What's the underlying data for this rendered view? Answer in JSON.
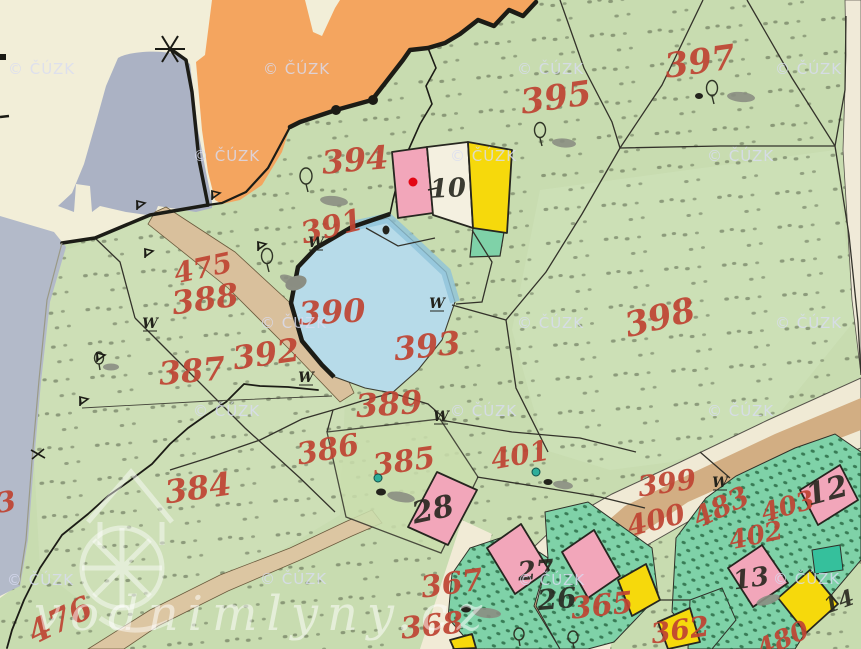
{
  "palette": {
    "paper": "#f2eed8",
    "green": "#c8dcb0",
    "green_light": "#d3e4c0",
    "orange": "#f4a55f",
    "gray_blue": "#abb2c4",
    "pond": "#b7dbe9",
    "pond_rim": "#8fc3da",
    "road_tan": "#d9c09c",
    "road_brown": "#cfa87c",
    "road_cream": "#f0ead5",
    "teal_garden": "#7fd2a8",
    "teal_bright": "#35c09c",
    "building_pink": "#f2a6ba",
    "building_yellow": "#f6d90c",
    "label_red": "#bf4433",
    "label_black": "#26261f",
    "boundary_ink": "#33322a",
    "watermark": "#d9dcf2",
    "red_dot": "#e30613",
    "well_teal": "#2fae9b"
  },
  "watermarks": {
    "cuzk": "© ČÚZK",
    "site": "vodnimlyny.cz",
    "cuzk_positions": [
      [
        8,
        74
      ],
      [
        263,
        74
      ],
      [
        517,
        74
      ],
      [
        775,
        74
      ],
      [
        193,
        161
      ],
      [
        450,
        161
      ],
      [
        707,
        161
      ],
      [
        260,
        328
      ],
      [
        517,
        328
      ],
      [
        775,
        328
      ],
      [
        193,
        416
      ],
      [
        450,
        416
      ],
      [
        707,
        416
      ],
      [
        7,
        585
      ],
      [
        260,
        584
      ],
      [
        518,
        585
      ],
      [
        773,
        584
      ]
    ]
  },
  "parcel_labels": [
    {
      "text": "397",
      "x": 700,
      "y": 62,
      "rot": -8,
      "size": 34
    },
    {
      "text": "395",
      "x": 556,
      "y": 98,
      "rot": -8,
      "size": 34
    },
    {
      "text": "394",
      "x": 355,
      "y": 160,
      "rot": -5,
      "size": 32
    },
    {
      "text": "391",
      "x": 332,
      "y": 227,
      "rot": -14,
      "size": 30
    },
    {
      "text": "475",
      "x": 203,
      "y": 268,
      "rot": -12,
      "size": 28
    },
    {
      "text": "388",
      "x": 205,
      "y": 299,
      "rot": -8,
      "size": 32
    },
    {
      "text": "390",
      "x": 332,
      "y": 312,
      "rot": -3,
      "size": 32
    },
    {
      "text": "393",
      "x": 427,
      "y": 346,
      "rot": -6,
      "size": 32
    },
    {
      "text": "398",
      "x": 660,
      "y": 318,
      "rot": -14,
      "size": 34
    },
    {
      "text": "387",
      "x": 192,
      "y": 371,
      "rot": -5,
      "size": 32
    },
    {
      "text": "392",
      "x": 266,
      "y": 354,
      "rot": -8,
      "size": 32
    },
    {
      "text": "389",
      "x": 389,
      "y": 404,
      "rot": -4,
      "size": 32
    },
    {
      "text": "386",
      "x": 328,
      "y": 450,
      "rot": -10,
      "size": 30
    },
    {
      "text": "385",
      "x": 404,
      "y": 462,
      "rot": -8,
      "size": 30
    },
    {
      "text": "401",
      "x": 520,
      "y": 455,
      "rot": -10,
      "size": 28
    },
    {
      "text": "384",
      "x": 198,
      "y": 488,
      "rot": -8,
      "size": 32
    },
    {
      "text": "399",
      "x": 667,
      "y": 483,
      "rot": -8,
      "size": 28
    },
    {
      "text": "400",
      "x": 656,
      "y": 520,
      "rot": -14,
      "size": 28
    },
    {
      "text": "483",
      "x": 721,
      "y": 507,
      "rot": -26,
      "size": 28
    },
    {
      "text": "403",
      "x": 788,
      "y": 507,
      "rot": -16,
      "size": 26
    },
    {
      "text": "402",
      "x": 756,
      "y": 536,
      "rot": -12,
      "size": 26
    },
    {
      "text": "367",
      "x": 452,
      "y": 584,
      "rot": -8,
      "size": 30
    },
    {
      "text": "368",
      "x": 432,
      "y": 626,
      "rot": -6,
      "size": 30
    },
    {
      "text": "365",
      "x": 602,
      "y": 606,
      "rot": -6,
      "size": 30
    },
    {
      "text": "362",
      "x": 680,
      "y": 630,
      "rot": -8,
      "size": 28
    },
    {
      "text": "476",
      "x": 60,
      "y": 620,
      "rot": -26,
      "size": 32
    },
    {
      "text": "480",
      "x": 783,
      "y": 640,
      "rot": -24,
      "size": 26
    },
    {
      "text": "3",
      "x": 6,
      "y": 502,
      "rot": -10,
      "size": 28
    }
  ],
  "building_labels": [
    {
      "text": "10",
      "x": 448,
      "y": 189,
      "rot": -3,
      "size": 26
    },
    {
      "text": "28",
      "x": 433,
      "y": 510,
      "rot": -12,
      "size": 30
    },
    {
      "text": "27",
      "x": 536,
      "y": 571,
      "rot": -5,
      "size": 26
    },
    {
      "text": "26",
      "x": 557,
      "y": 599,
      "rot": -5,
      "size": 28
    },
    {
      "text": "12",
      "x": 827,
      "y": 491,
      "rot": -15,
      "size": 30
    },
    {
      "text": "13",
      "x": 751,
      "y": 579,
      "rot": -8,
      "size": 26
    },
    {
      "text": "14",
      "x": 839,
      "y": 602,
      "rot": -20,
      "size": 22
    }
  ],
  "meadow_symbols": {
    "glyph": "W",
    "positions": [
      [
        316,
        243
      ],
      [
        150,
        324
      ],
      [
        437,
        304
      ],
      [
        306,
        378
      ],
      [
        441,
        417
      ],
      [
        720,
        483
      ]
    ]
  },
  "map_marks": {
    "red_dot": {
      "x": 413,
      "y": 182
    },
    "wells": [
      [
        378,
        478
      ],
      [
        536,
        472
      ]
    ]
  }
}
